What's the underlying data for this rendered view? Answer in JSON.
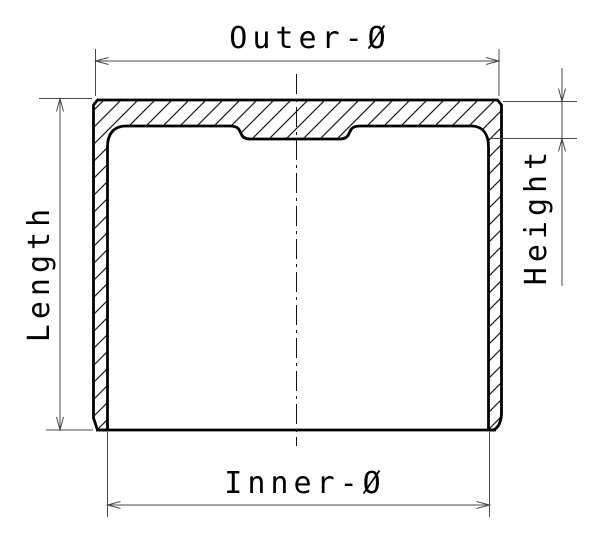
{
  "figure": {
    "type": "technical-drawing",
    "view": "cross-section"
  },
  "dimensions": [
    {
      "id": "outer-diameter",
      "label": "Outer-Ø",
      "orientation": "horizontal",
      "position": "top"
    },
    {
      "id": "length",
      "label": "Length",
      "orientation": "vertical",
      "position": "left"
    },
    {
      "id": "height",
      "label": "Height",
      "orientation": "vertical",
      "position": "right"
    },
    {
      "id": "inner-diameter",
      "label": "Inner-Ø",
      "orientation": "horizontal",
      "position": "bottom"
    }
  ],
  "colors": {
    "background": "#ffffff",
    "part_outline": "#000000",
    "hatch_lines": "#1a1a1a",
    "dimension_lines": "#4a4a4a",
    "label_text": "#000000"
  }
}
